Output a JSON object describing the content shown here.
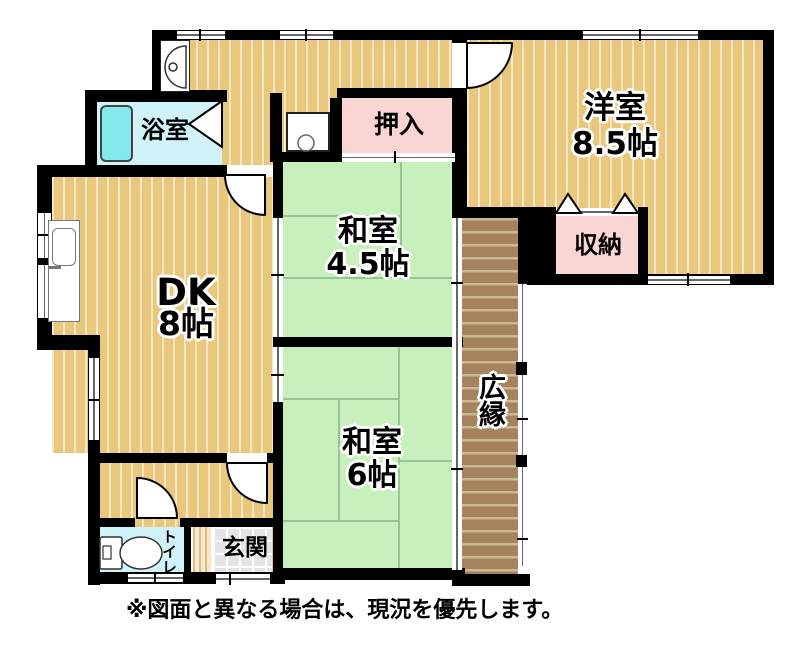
{
  "plan": {
    "rooms": {
      "western": {
        "label": "洋室",
        "size": "8.5帖"
      },
      "washitsu45": {
        "label": "和室",
        "size": "4.5帖"
      },
      "washitsu6": {
        "label": "和室",
        "size": "6帖"
      },
      "dk": {
        "label": "DK",
        "size": "8帖"
      },
      "bathroom": {
        "label": "浴室"
      },
      "oshiire": {
        "label": "押入"
      },
      "storage": {
        "label": "収納"
      },
      "hiroen": {
        "label": "広縁"
      },
      "toilet": {
        "label": "トイレ"
      },
      "genkan": {
        "label": "玄関"
      }
    },
    "note": "※図面と異なる場合は、現況を優先します。",
    "colors": {
      "wood_floor": "#e9c77c",
      "tatami_green": "#c7f0bd",
      "closet_pink": "#f9d5d3",
      "bath_cyan": "#cff3f8",
      "bathtub_cyan": "#84e9ef",
      "veranda_brown": "#a6835f",
      "genkan_gray": "#e4e4e4",
      "wall_black": "#000000"
    }
  }
}
